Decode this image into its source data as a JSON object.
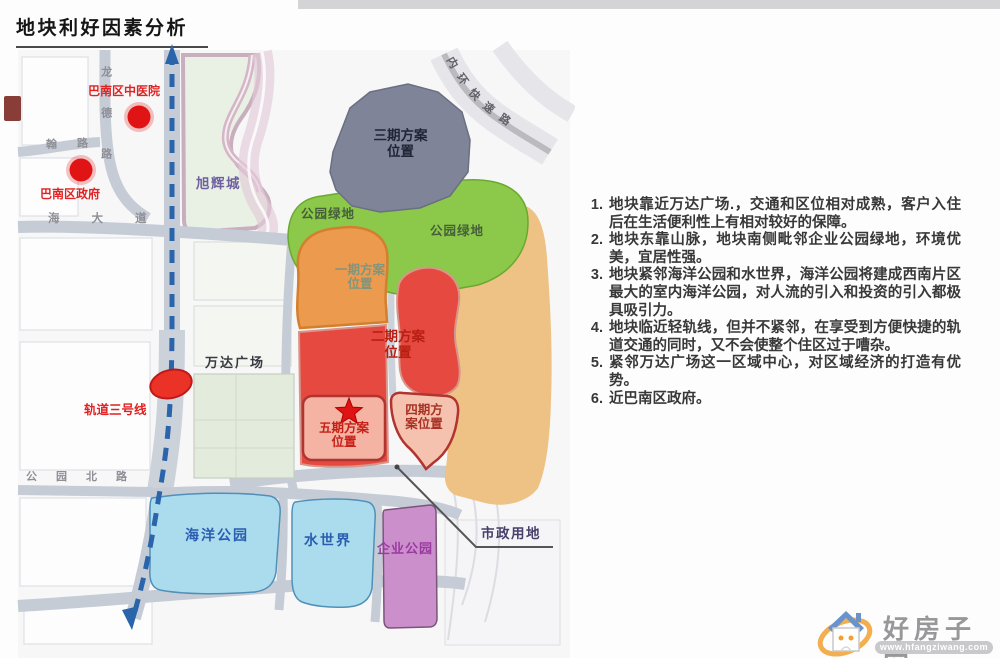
{
  "title": "地块利好因素分析",
  "list": {
    "items": [
      {
        "num": "1.",
        "text": "地块靠近万达广场.，交通和区位相对成熟，客户入住后在生活便利性上有相对较好的保障。"
      },
      {
        "num": "2.",
        "text": "地块东靠山脉，地块南侧毗邻企业公园绿地，环境优美，宜居性强。"
      },
      {
        "num": "3.",
        "text": "地块紧邻海洋公园和水世界，海洋公园将建成西南片区最大的室内海洋公园，对人流的引入和投资的引入都极具吸引力。"
      },
      {
        "num": "4.",
        "text": "地块临近轻轨线，但并不紧邻，在享受到方便快捷的轨道交通的同时，又不会使整个住区过于嘈杂。"
      },
      {
        "num": "5.",
        "text": "紧邻万达广场这一区域中心，对区域经济的打造有优势。"
      },
      {
        "num": "6.",
        "text": "近巴南区政府。"
      }
    ]
  },
  "map": {
    "landmarks": {
      "hospital": "巴南区中医院",
      "government": "巴南区政府",
      "xuhui_city": "旭辉城",
      "wanda_plaza": "万达广场",
      "rail_line3": "轨道三号线"
    },
    "zones": {
      "phase1": {
        "line1": "一期方案",
        "line2": "位置"
      },
      "phase2": {
        "line1": "二期方案",
        "line2": "位置"
      },
      "phase3": {
        "line1": "三期方案",
        "line2": "位置"
      },
      "phase4": {
        "line1": "四期方",
        "line2": "案位置"
      },
      "phase5": {
        "line1": "五期方案",
        "line2": "位置"
      },
      "park_green_left": "公园绿地",
      "park_green_right": "公园绿地",
      "ocean_park": "海洋公园",
      "water_world": "水世界",
      "enterprise_park": "企业公园",
      "municipal_land": "市政用地"
    },
    "roads": {
      "haida_avenue": "海大道",
      "gongyuan_north_road": "公园北路",
      "longde_road": "龙德路",
      "han_road": "翰路",
      "inner_ring_expressway": "内环快速路"
    }
  },
  "watermark": {
    "site_name": "好房子网",
    "site_url": "www.hfangziwang.com"
  },
  "colors": {
    "phase_red": "#e6493f",
    "phase_orange": "#ec9a4e",
    "phase_gray": "#7f8498",
    "phase_pink": "#f4b3a3",
    "park_green": "#8cc84a",
    "reserve_tan": "#eec184",
    "water_blue": "#abdcee",
    "enterprise_purple": "#cb8fcb",
    "rail_blue": "#2a64aa",
    "marker_red": "#e01414"
  }
}
